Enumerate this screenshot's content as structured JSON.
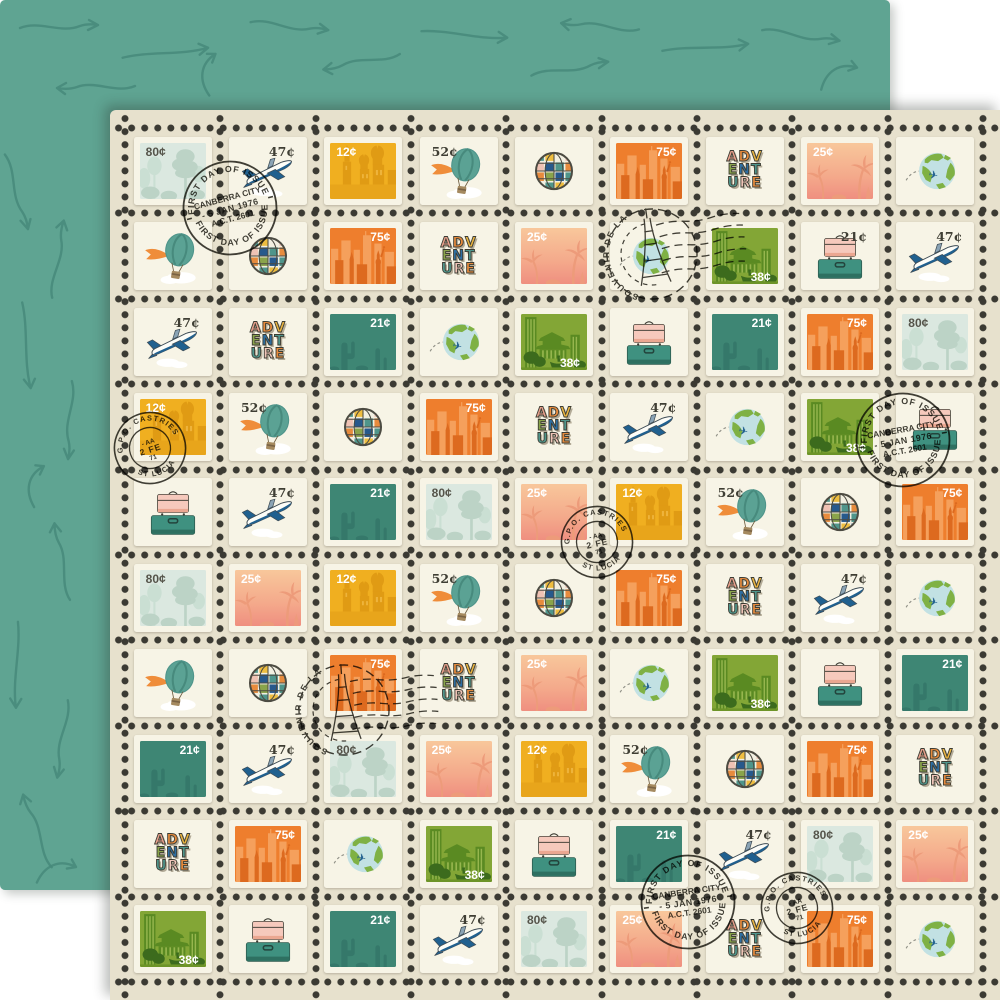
{
  "product": {
    "description": "Double-sided scrapbook paper: front is a sheet of travel postage stamps with perforation dots and cancellation postmarks, back is teal with hand-drawn arrow doodles"
  },
  "back_paper": {
    "color": "#5fa492",
    "arrow_color": "#46897a"
  },
  "front_paper": {
    "margin_color": "#e7e1cd",
    "stamp_paper_color": "#f7f4e6",
    "perforation_dot_color": "#3b3a33",
    "grid": {
      "rows": 10,
      "cols": 9
    }
  },
  "stamp_types": {
    "tree": {
      "name": "forest trees",
      "denomination": "80¢",
      "label_style": "dks",
      "label_pos": "tl",
      "background": "#dbe8e0",
      "art_color": "#bcd3c6"
    },
    "plane": {
      "name": "jet airplane",
      "denomination": "47¢",
      "label_style": "dk",
      "label_pos": "tr",
      "background": "#f7f4e6",
      "art_color": "#20608f"
    },
    "castle": {
      "name": "onion-dome cathedral",
      "denomination": "12¢",
      "label_style": "lt",
      "label_pos": "tl",
      "background": "#f0af20",
      "art_color": "#e09b14"
    },
    "balloon": {
      "name": "hot air balloon",
      "denomination": "52¢",
      "label_style": "dk",
      "label_pos": "tl",
      "background": "#f7f4e6",
      "art_color": "#5ba294"
    },
    "globe": {
      "name": "striped decorative globe",
      "denomination": "",
      "background": "#f7f4e6"
    },
    "city": {
      "name": "skyline with Statue of Liberty",
      "denomination": "75¢",
      "label_style": "lt",
      "label_pos": "tr",
      "background": "#ee7e2d",
      "art_color": "#dd6a1f"
    },
    "adv": {
      "name": "ADVENTURE lettering",
      "denomination": "",
      "background": "#f7f4e6",
      "letters": [
        [
          "A",
          "D",
          "V"
        ],
        [
          "E",
          "N",
          "T"
        ],
        [
          "U",
          "R",
          "E"
        ]
      ],
      "letter_colors": [
        "#e8a08c",
        "#e78b3d",
        "#eab440",
        "#8aa44b",
        "#2e6ea1",
        "#4f958b",
        "#4f958b",
        "#f0c5b8",
        "#e78b3d"
      ]
    },
    "palm": {
      "name": "palm trees at sunset",
      "denomination": "25¢",
      "label_style": "lt",
      "label_pos": "tl",
      "background": "#f4a98b",
      "art_color": "#ed9b7a"
    },
    "earth": {
      "name": "earth with flying airplane",
      "denomination": "",
      "background": "#f7f4e6",
      "ocean": "#c2e1e3",
      "land": "#7fb144"
    },
    "green": {
      "name": "green harbor city",
      "denomination": "38¢",
      "label_style": "lt",
      "label_pos": "br",
      "background": "#83a636",
      "art_color": "#3c6b1d"
    },
    "case": {
      "name": "stacked suitcases",
      "denomination": "21¢",
      "label_style": "dk",
      "label_pos": "tr",
      "background": "#f7f4e6",
      "case_colors": [
        "#f6c9bc",
        "#3f9180"
      ]
    },
    "cactus": {
      "name": "desert cactus",
      "denomination": "21¢",
      "label_style": "lt",
      "label_pos": "tr",
      "background": "#3e8674",
      "art_color": "#35786a"
    }
  },
  "grid_cells": [
    [
      "tree:80¢",
      "plane:47¢",
      "castle:12¢",
      "balloon:52¢",
      "globe:",
      "city:75¢",
      "adv:",
      "palm:25¢",
      "earth:"
    ],
    [
      "balloon:",
      "globe:",
      "city:75¢",
      "adv:",
      "palm:25¢",
      "earth:",
      "green:38¢",
      "case:21¢",
      "plane:47¢"
    ],
    [
      "plane:47¢",
      "adv:",
      "cactus:21¢",
      "earth:",
      "green:38¢",
      "case:",
      "cactus:21¢",
      "city:75¢",
      "tree:80¢"
    ],
    [
      "castle:12¢",
      "balloon:52¢",
      "globe:",
      "city:75¢",
      "adv:",
      "plane:47¢",
      "earth:",
      "green:38¢",
      "case:"
    ],
    [
      "case:",
      "plane:47¢",
      "cactus:21¢",
      "tree:80¢",
      "palm:25¢",
      "castle:12¢",
      "balloon:52¢",
      "globe:",
      "city:75¢"
    ],
    [
      "tree:80¢",
      "palm:25¢",
      "castle:12¢",
      "balloon:52¢",
      "globe:",
      "city:75¢",
      "adv:",
      "plane:47¢",
      "earth:"
    ],
    [
      "balloon:",
      "globe:",
      "city:75¢",
      "adv:",
      "palm:25¢",
      "earth:",
      "green:38¢",
      "case:",
      "cactus:21¢"
    ],
    [
      "cactus:21¢",
      "plane:47¢",
      "tree:80¢",
      "palm:25¢",
      "castle:12¢",
      "balloon:52¢",
      "globe:",
      "city:75¢",
      "adv:"
    ],
    [
      "adv:",
      "city:75¢",
      "earth:",
      "green:38¢",
      "case:",
      "cactus:21¢",
      "plane:47¢",
      "tree:80¢",
      "palm:25¢"
    ],
    [
      "green:38¢",
      "case:",
      "cactus:21¢",
      "plane:47¢",
      "tree:80¢",
      "palm:25¢",
      "adv:",
      "city:75¢",
      "earth:"
    ]
  ],
  "postmark_text": {
    "first_day": {
      "arc_top": "FIRST DAY OF ISSUE",
      "line1": "CANBERRA CITY",
      "line2": "- 5 JAN 1976",
      "line3": "A.C.T. 2601",
      "arc_bottom": "FIRST DAY OF ISSUE"
    },
    "gpo": {
      "arc_top": "G.P.O. CASTRIES",
      "line1": "- AA",
      "line2": "2 FE",
      "line3": "71",
      "arc_bottom": "ST LUCIA"
    },
    "souvenir": {
      "arc": "SOUVENIR DE LA"
    }
  },
  "postmarks": [
    {
      "type": "first_day",
      "cx": 230,
      "cy": 208,
      "rot": -15
    },
    {
      "type": "souvenir",
      "cx": 652,
      "cy": 254,
      "rot": -8
    },
    {
      "type": "gpo",
      "cx": 150,
      "cy": 448,
      "rot": -18
    },
    {
      "type": "first_day",
      "cx": 903,
      "cy": 440,
      "rot": -10
    },
    {
      "type": "gpo",
      "cx": 597,
      "cy": 542,
      "rot": -12
    },
    {
      "type": "souvenir",
      "cx": 344,
      "cy": 710,
      "rot": -4
    },
    {
      "type": "first_day",
      "cx": 688,
      "cy": 902,
      "rot": -8
    },
    {
      "type": "gpo",
      "cx": 797,
      "cy": 908,
      "rot": -15
    }
  ]
}
